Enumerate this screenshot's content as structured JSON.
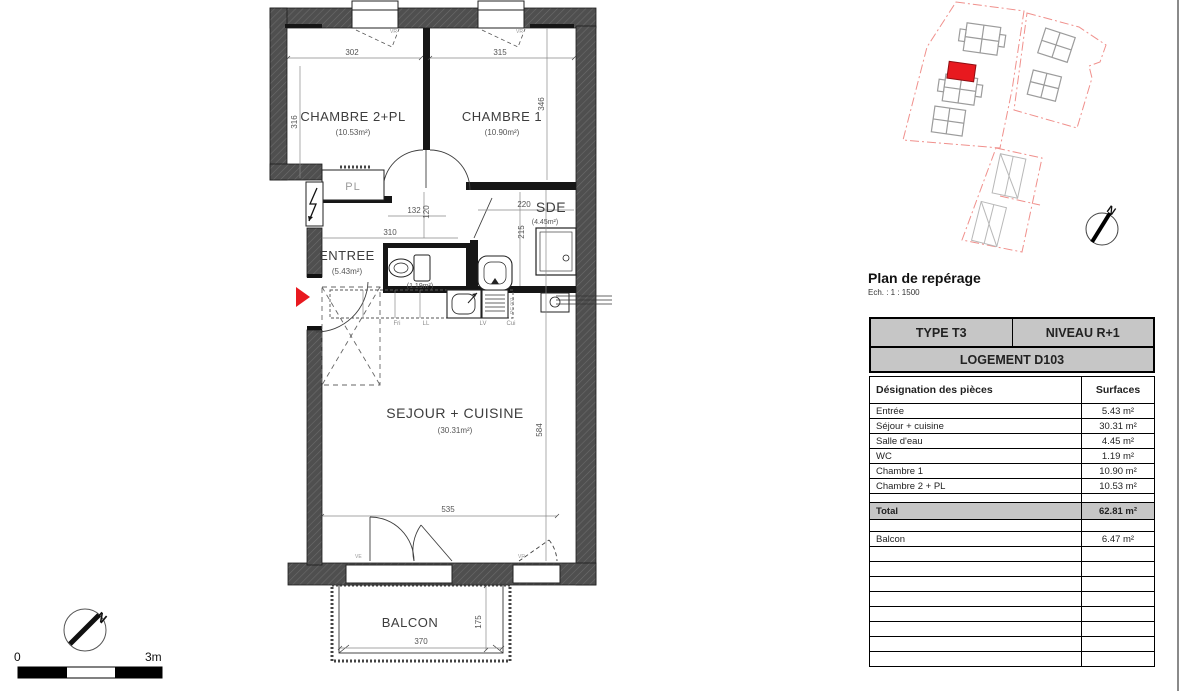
{
  "plan": {
    "rooms": {
      "chambre2_name": "CHAMBRE 2+PL",
      "chambre2_area": "(10.53m²)",
      "chambre1_name": "CHAMBRE 1",
      "chambre1_area": "(10.90m²)",
      "sde_name": "SDE",
      "sde_area": "(4.45m²)",
      "entree_name": "ENTREE",
      "entree_area": "(5.43m²)",
      "wc_area": "(1.19m²)",
      "sejour_name": "SEJOUR + CUISINE",
      "sejour_area": "(30.31m²)",
      "balcon_name": "BALCON",
      "pl_label": "PL"
    },
    "dims": {
      "d302": "302",
      "d315": "315",
      "d316": "316",
      "d346": "346",
      "d310": "310",
      "d132": "132",
      "d120": "120",
      "d220": "220",
      "d215": "215",
      "d535": "535",
      "d584": "584",
      "d370": "370",
      "d175": "175"
    },
    "tags": {
      "fri": "Fri",
      "ll": "LL",
      "lv": "LV",
      "cui": "Cui",
      "pc": "PC 001",
      "vr_top_left": "VR",
      "vr_top_right": "VR",
      "ve_bottom": "VE",
      "vr_bottom": "VR"
    },
    "scalebar": {
      "zero": "0",
      "max": "3m"
    },
    "north": "N",
    "accent_red": "#e8191f",
    "wall_gray": "#4f4f4f"
  },
  "reperage": {
    "title": "Plan de repérage",
    "ech": "Ech. : 1 : 1500",
    "north": "N",
    "site_red": "#f0908c"
  },
  "table": {
    "type": "TYPE T3",
    "niveau": "NIVEAU R+1",
    "logement": "LOGEMENT D103",
    "col_name": "Désignation des pièces",
    "col_surface": "Surfaces",
    "rows": [
      {
        "name": "Entrée",
        "surface": "5.43 m²"
      },
      {
        "name": "Séjour + cuisine",
        "surface": "30.31 m²"
      },
      {
        "name": "Salle d'eau",
        "surface": "4.45 m²"
      },
      {
        "name": "WC",
        "surface": "1.19 m²"
      },
      {
        "name": "Chambre 1",
        "surface": "10.90 m²"
      },
      {
        "name": "Chambre 2 + PL",
        "surface": "10.53 m²"
      }
    ],
    "total": {
      "name": "Total",
      "surface": "62.81 m²"
    },
    "balcon": {
      "name": "Balcon",
      "surface": "6.47 m²"
    }
  }
}
